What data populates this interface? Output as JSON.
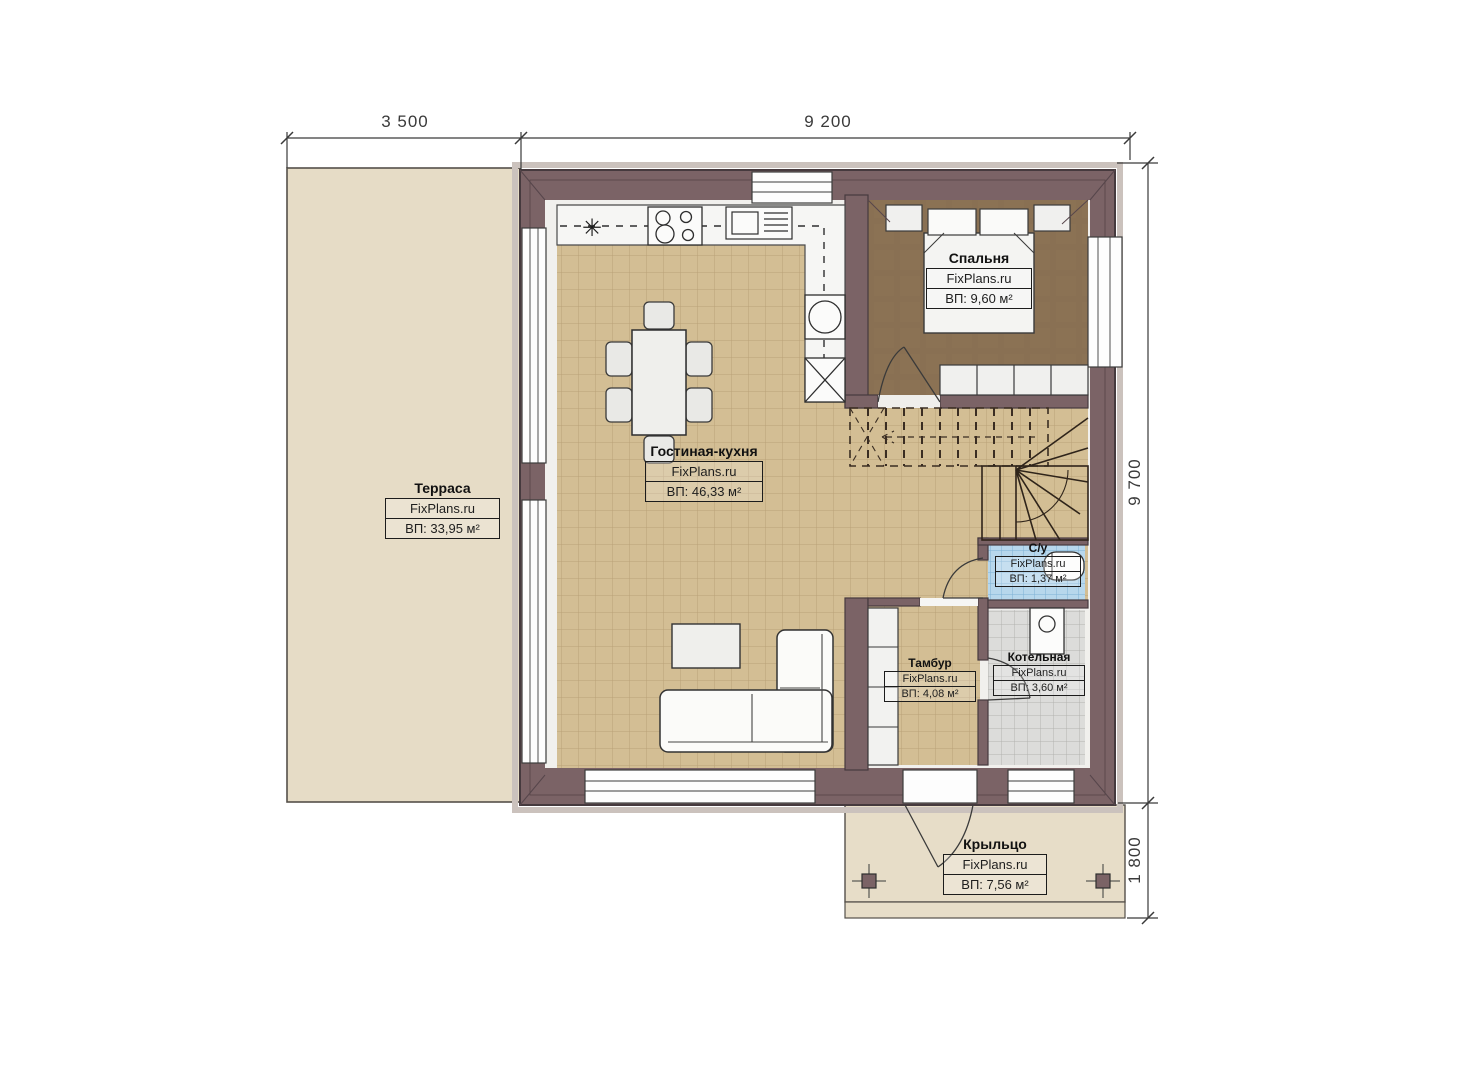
{
  "plan_title": "План 1 этажа",
  "dimensions": {
    "top": [
      {
        "label": "3 500"
      },
      {
        "label": "9 200"
      }
    ],
    "right": [
      {
        "label": "9 700"
      },
      {
        "label": "1 800"
      }
    ]
  },
  "rooms": {
    "terrace": {
      "name": "Терраса",
      "brand": "FixPlans.ru",
      "area": "ВП: 33,95 м²"
    },
    "living": {
      "name": "Гостиная-кухня",
      "brand": "FixPlans.ru",
      "area": "ВП: 46,33 м²"
    },
    "bedroom": {
      "name": "Спальня",
      "brand": "FixPlans.ru",
      "area": "ВП: 9,60 м²"
    },
    "bathroom": {
      "name": "С/у",
      "brand": "FixPlans.ru",
      "area": "ВП: 1,37 м²"
    },
    "tambour": {
      "name": "Тамбур",
      "brand": "FixPlans.ru",
      "area": "ВП: 4,08 м²"
    },
    "boiler": {
      "name": "Котельная",
      "brand": "FixPlans.ru",
      "area": "ВП: 3,60 м²"
    },
    "porch": {
      "name": "Крыльцо",
      "brand": "FixPlans.ru",
      "area": "ВП: 7,56 м²"
    }
  },
  "icons": {
    "ceiling_light": "✳"
  },
  "colors": {
    "wall": "#7b6366",
    "wallLine": "#463a3e",
    "wallTrim": "#cbc2bd",
    "interior": "#f1f0ed",
    "terrace": "#e6dcc6",
    "porch": "#e7ddc8",
    "tileTan": "#d3be94",
    "tileLine": "#a5895f",
    "bedroomFloor": "#8b7254",
    "bathFloor": "#b7d7ec",
    "bathLine": "#6fa8cf",
    "boilerFloor": "#dcdcda",
    "boilerLine": "#aeaeac",
    "furniture": "#f4f4f2",
    "lineDark": "#3c3c3c",
    "dim": "#3a3a3a"
  }
}
